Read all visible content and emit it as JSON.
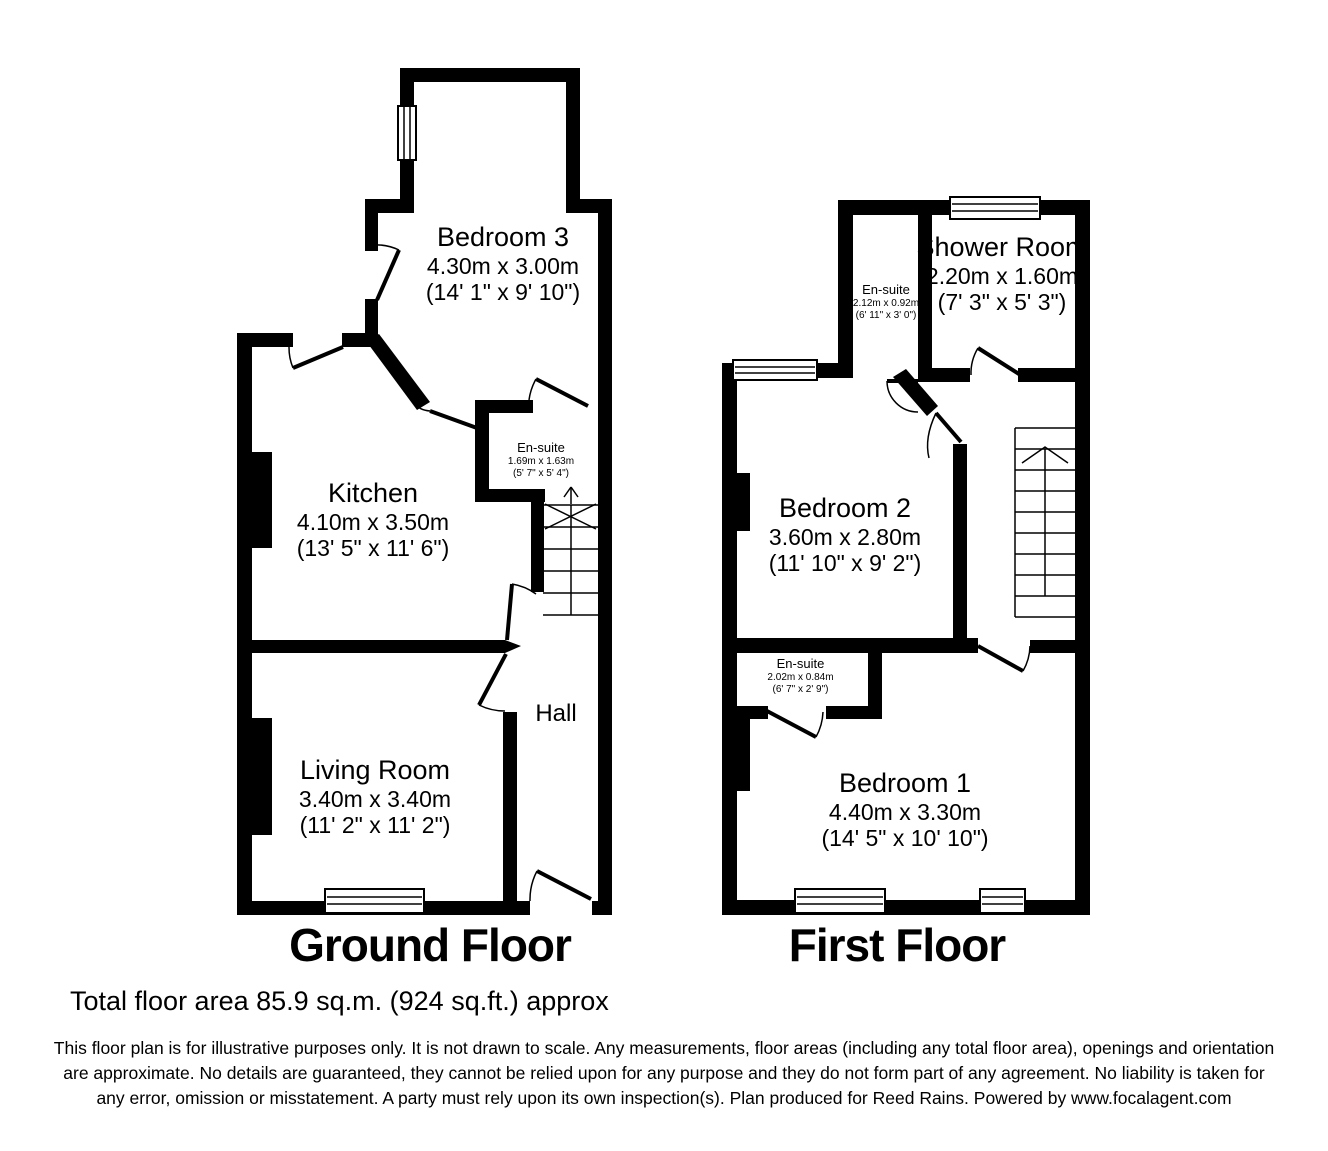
{
  "colors": {
    "wall": "#000000",
    "background": "#ffffff",
    "text": "#000000"
  },
  "floors": [
    {
      "label": "Ground Floor",
      "rooms": {
        "bedroom3": {
          "name": "Bedroom 3",
          "metric": "4.30m x 3.00m",
          "imperial": "(14' 1\" x 9' 10\")"
        },
        "kitchen": {
          "name": "Kitchen",
          "metric": "4.10m x 3.50m",
          "imperial": "(13' 5\" x 11' 6\")"
        },
        "ensuite": {
          "name": "En-suite",
          "metric": "1.69m x 1.63m",
          "imperial": "(5' 7\" x 5' 4\")"
        },
        "living_room": {
          "name": "Living Room",
          "metric": "3.40m x 3.40m",
          "imperial": "(11' 2\" x 11' 2\")"
        },
        "hall": {
          "name": "Hall"
        }
      }
    },
    {
      "label": "First Floor",
      "rooms": {
        "ensuite_top": {
          "name": "En-suite",
          "metric": "2.12m x 0.92m",
          "imperial": "(6' 11\" x 3' 0\")"
        },
        "shower_room": {
          "name": "Shower Room",
          "metric": "2.20m x 1.60m",
          "imperial": "(7' 3\" x 5' 3\")"
        },
        "bedroom2": {
          "name": "Bedroom 2",
          "metric": "3.60m x 2.80m",
          "imperial": "(11' 10\" x 9' 2\")"
        },
        "ensuite_bottom": {
          "name": "En-suite",
          "metric": "2.02m x 0.84m",
          "imperial": "(6' 7\" x 2' 9\")"
        },
        "bedroom1": {
          "name": "Bedroom 1",
          "metric": "4.40m x 3.30m",
          "imperial": "(14' 5\" x 10' 10\")"
        }
      }
    }
  ],
  "summary": {
    "total_area": "Total floor area 85.9 sq.m. (924 sq.ft.) approx"
  },
  "disclaimer": "This floor plan is for illustrative purposes only. It is not drawn to scale. Any measurements, floor areas (including any total floor area), openings and orientation are approximate. No details are guaranteed, they cannot be relied upon for any purpose and they do not form part of any agreement. No liability is taken for any error, omission or misstatement. A party must rely upon its own inspection(s). Plan produced for Reed Rains. Powered by www.focalagent.com"
}
